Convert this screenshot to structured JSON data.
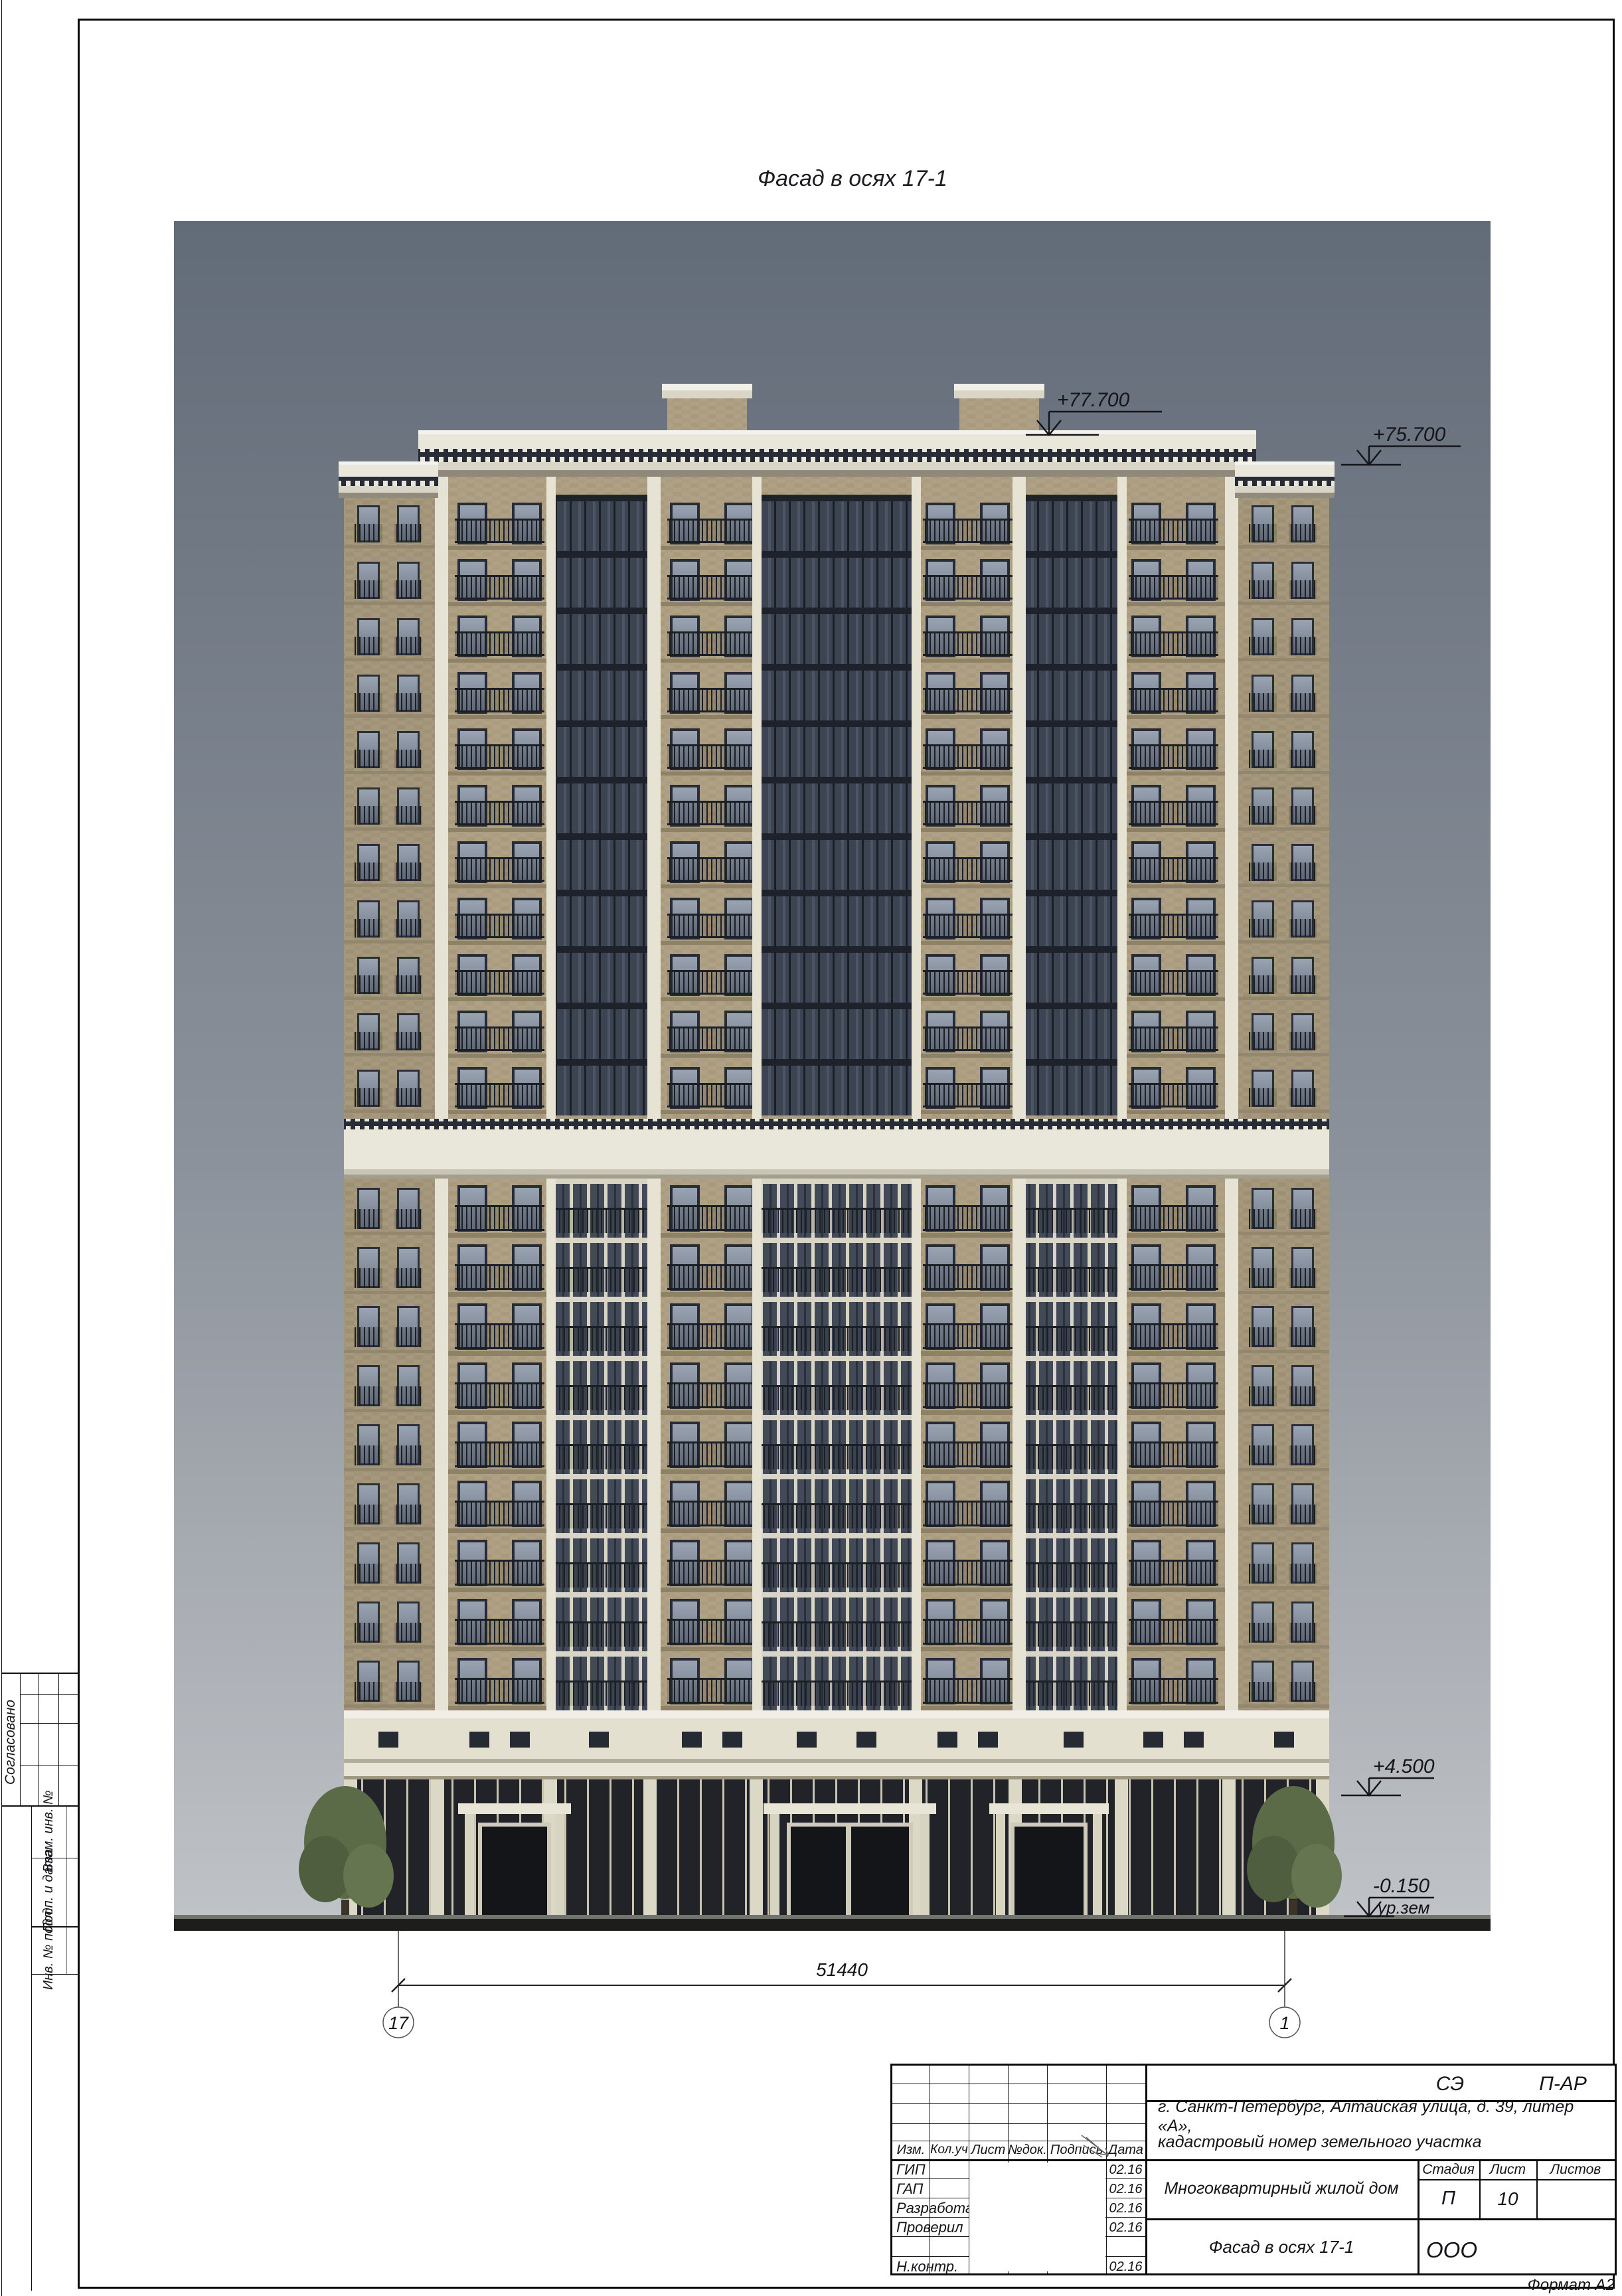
{
  "drawing": {
    "title": "Фасад в осях 17-1"
  },
  "annotations": {
    "elev_roof": "+77.700",
    "elev_parapet": "+75.700",
    "elev_first": "+4.500",
    "elev_ground": "-0.150",
    "ground_label": "ур.зем",
    "dimension": "51440",
    "axis_left": "17",
    "axis_right": "1"
  },
  "titleblock": {
    "code_left": "СЭ",
    "code_right": "П-АР",
    "address_line1": "г. Санкт-Петербург, Алтайская улица, д. 39, литер «А»,",
    "address_line2": "кадастровый номер земельного участка",
    "project": "Многоквартирный жилой дом",
    "sheet_title": "Фасад в осях 17-1",
    "org": "ООО",
    "format": "Формат А2",
    "h": [
      "Изм.",
      "Кол.уч",
      "Лист",
      "№док.",
      "Подпись",
      "Дата"
    ],
    "stage_label": "Стадия",
    "sheet_label": "Лист",
    "sheets_label": "Листов",
    "stage": "П",
    "sheet_no": "10",
    "sheets_total": "",
    "rows": [
      {
        "role": "ГИП",
        "date": "02.16"
      },
      {
        "role": "ГАП",
        "date": "02.16"
      },
      {
        "role": "Разработал",
        "date": "02.16"
      },
      {
        "role": "Проверил",
        "date": "02.16"
      },
      {
        "role": "",
        "date": ""
      },
      {
        "role": "Н.контр.",
        "date": "02.16"
      }
    ]
  },
  "margin": {
    "approved": "Согласовано",
    "vzam": "Взам. инв. №",
    "podp": "Подп. и дата",
    "inv": "Инв. № подл."
  },
  "colors": {
    "sky_top": "#626b78",
    "sky_bottom": "#c0c3c7",
    "brick": "#b0a185",
    "cream": "#e9e6da",
    "glazing": "#3c4452",
    "ground_dark": "#2e2c26"
  }
}
